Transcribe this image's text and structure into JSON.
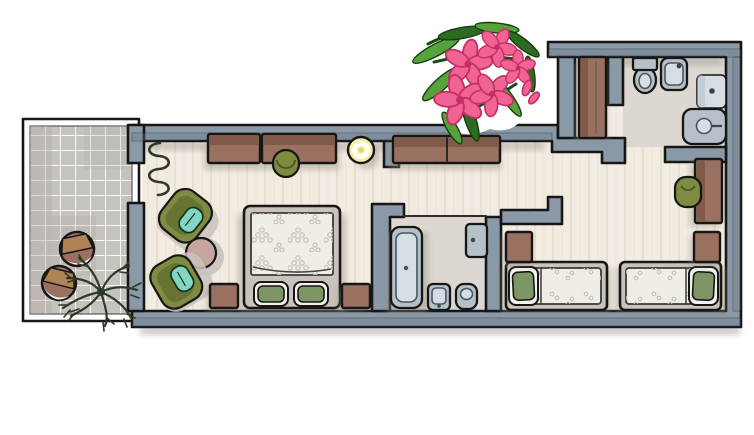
{
  "illustration": {
    "type": "watercolor-floor-plan",
    "label": "Apartment floor plan, top view, watercolor illustration",
    "decor_overlay": "pink oleander flower branch sticker"
  },
  "palette": {
    "paper": "#ffffff",
    "outline": "#161616",
    "wall": "#8a99a8",
    "wall-shade": "#66798b",
    "floor": "#f2ebe2",
    "floor-streak": "#ddd0bd",
    "bath-floor": "#dcd7d0",
    "tile": "#c6c2be",
    "tile-shade": "#aeaaa5",
    "grout": "#ffffff",
    "wood": "#9a7160",
    "wood-dark": "#6f4b3e",
    "chair-green": "#7e8b41",
    "chair-green-dark": "#4f5c26",
    "cushion-teal": "#82d7c3",
    "pillow-green": "#7e9566",
    "duvet": "#f0ede7",
    "duvet-dot": "#c7bfb3",
    "mat-gray": "#c9c3bb",
    "blush": "#c4a5a0",
    "lamp-yellow": "#f4f1a3",
    "fixture": "#b5c0c9",
    "fixture-light": "#d5dee3",
    "shadow": "#8f897e",
    "plant-dark": "#2e3a27",
    "flower-pink": "#f06392",
    "flower-deep": "#c22f67",
    "leaf-green": "#57a33b",
    "leaf-dark": "#2c6b21"
  },
  "rooms": [
    {
      "id": "balcony",
      "label": "Balcony with tiled floor",
      "furniture": [
        "wooden stool",
        "wooden stool",
        "leafy potted plant"
      ]
    },
    {
      "id": "living-bedroom",
      "label": "Living room / master bedroom",
      "furniture": [
        "radiator",
        "sideboard desk",
        "desk chair",
        "ceiling lamp",
        "armchair",
        "armchair",
        "round side table",
        "double bed with two pillows",
        "nightstand",
        "nightstand"
      ]
    },
    {
      "id": "bathroom-1",
      "label": "Bathroom",
      "furniture": [
        "bathtub",
        "toilet",
        "bidet",
        "washbasin"
      ]
    },
    {
      "id": "hallway",
      "label": "Hallway",
      "furniture": [
        "wardrobe"
      ]
    },
    {
      "id": "entrance-hall",
      "label": "Entrance hall",
      "furniture": [
        "wardrobe"
      ]
    },
    {
      "id": "bathroom-2",
      "label": "Second bathroom",
      "furniture": [
        "toilet",
        "sink",
        "shower",
        "washbasin"
      ]
    },
    {
      "id": "bedroom-2",
      "label": "Second bedroom",
      "furniture": [
        "single bed",
        "single bed",
        "nightstand",
        "nightstand",
        "desk",
        "desk chair"
      ]
    }
  ]
}
